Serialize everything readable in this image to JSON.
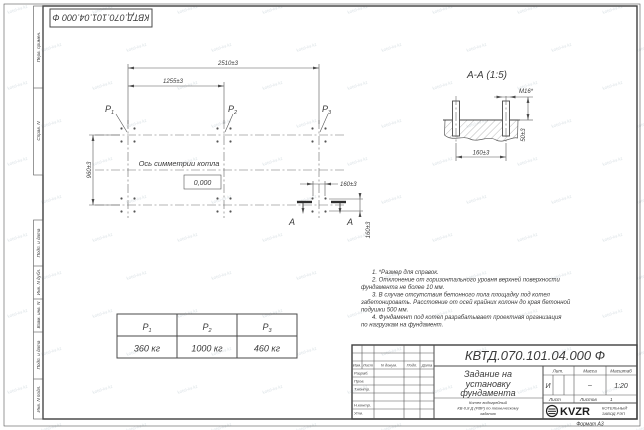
{
  "page": {
    "format_label": "Формат А3"
  },
  "stamp_top": {
    "doc_number": "КВТД.070.101.04.000 Ф"
  },
  "margin": {
    "labels": [
      "Перв. примен.",
      "Справ. N",
      "Подп. и дата",
      "Инв. N дубл.",
      "Взам. инв. N",
      "Подп. и дата",
      "Инв. N подл."
    ]
  },
  "plan": {
    "dim_overall": "2510±3",
    "dim_half": "1255±3",
    "dim_depth": "960±3",
    "dim_bolt_x": "160±3",
    "dim_bolt_y": "160±3",
    "axis_label": "Ось симметрии котла",
    "level_mark": "0,000",
    "p_labels": [
      {
        "base": "Р",
        "sub": "1"
      },
      {
        "base": "Р",
        "sub": "2"
      },
      {
        "base": "Р",
        "sub": "3"
      }
    ],
    "section_letter_left": "А",
    "section_letter_right": "А"
  },
  "section": {
    "title": "А-А (1:5)",
    "bolt_label": "М16*",
    "dim_width": "160±3",
    "dim_height": "50±3"
  },
  "load_table": {
    "headers": [
      {
        "base": "Р",
        "sub": "1"
      },
      {
        "base": "Р",
        "sub": "2"
      },
      {
        "base": "Р",
        "sub": "3"
      }
    ],
    "values": [
      "360 кг",
      "1000 кг",
      "460 кг"
    ]
  },
  "notes": {
    "lines": [
      "1. *Размер для справок.",
      "2. Отклонение от горизонтального уровня верхней поверхности",
      "фундамента не более 10 мм.",
      "3. В случае отсутствия бетонного пола площадку под котел",
      "забетонировать. Расстояние от осей крайних колонн до края бетонной",
      "подушки 500 мм.",
      "4. Фундамент под котел разрабатывает проектная организация",
      "по нагрузкам на фундамент."
    ]
  },
  "title_block": {
    "doc_number": "КВТД.070.101.04.000 Ф",
    "title_line1": "Задание на",
    "title_line2": "установку",
    "title_line3": "фундамента",
    "subtitle_line1": "Котел водогрейный",
    "subtitle_line2": "КВ-0,8 Д (РВР) по техническому",
    "subtitle_line3": "заданию",
    "header_cols": [
      "Изм.",
      "Лист",
      "N докум.",
      "Подп.",
      "Дата"
    ],
    "row_labels": [
      "Разраб.",
      "Пров.",
      "Т.контр.",
      "Н.контр.",
      "Утв."
    ],
    "lit_label": "Лит.",
    "lit_value": "И",
    "mass_label": "Масса",
    "mass_value": "–",
    "scale_label": "Масштаб",
    "scale_value": "1:20",
    "sheet_label": "Лист",
    "sheets_label": "Листов",
    "sheets_value": "1",
    "company": {
      "logo": "KVZR",
      "name_line1": "КОТЕЛЬНЫЙ",
      "name_line2": "ЗАВОД РЭП"
    }
  },
  "watermark": {
    "text": "kotel-kv.kz"
  }
}
